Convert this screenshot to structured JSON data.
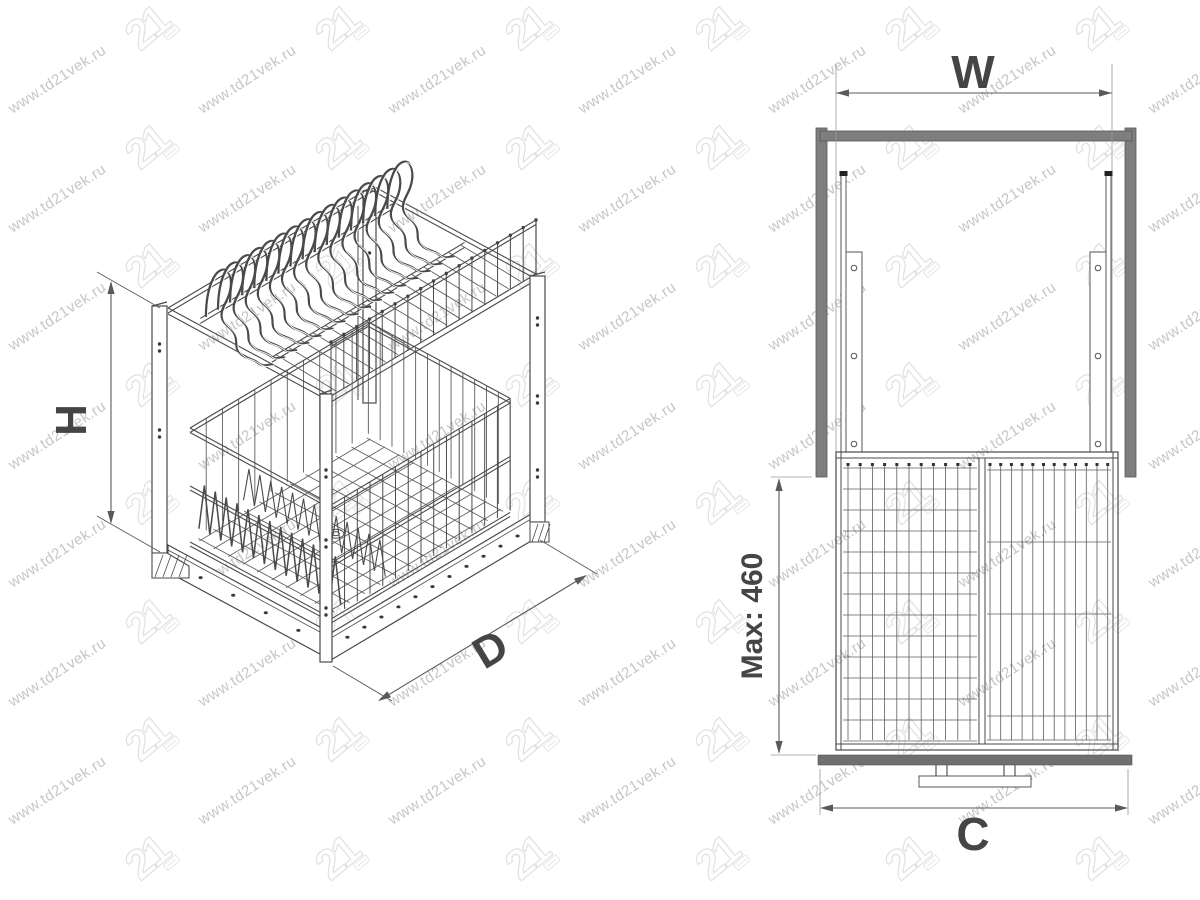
{
  "labels": {
    "height": "H",
    "depth": "D",
    "width": "W",
    "cabinet_width": "C",
    "max_drop": "Max: 460"
  },
  "watermark": {
    "text": "www.td21vek.ru",
    "logo_text": "21"
  },
  "colors": {
    "line": "#4a4a4a",
    "mesh": "#5d5d5d",
    "cabinet_fill": "#7e7e7e",
    "floor_fill": "#6f6f6f",
    "label": "#454545",
    "dim_line": "#5a5a5a",
    "watermark_text": "#c6c6c6",
    "watermark_logo": "#e1e1e1"
  }
}
